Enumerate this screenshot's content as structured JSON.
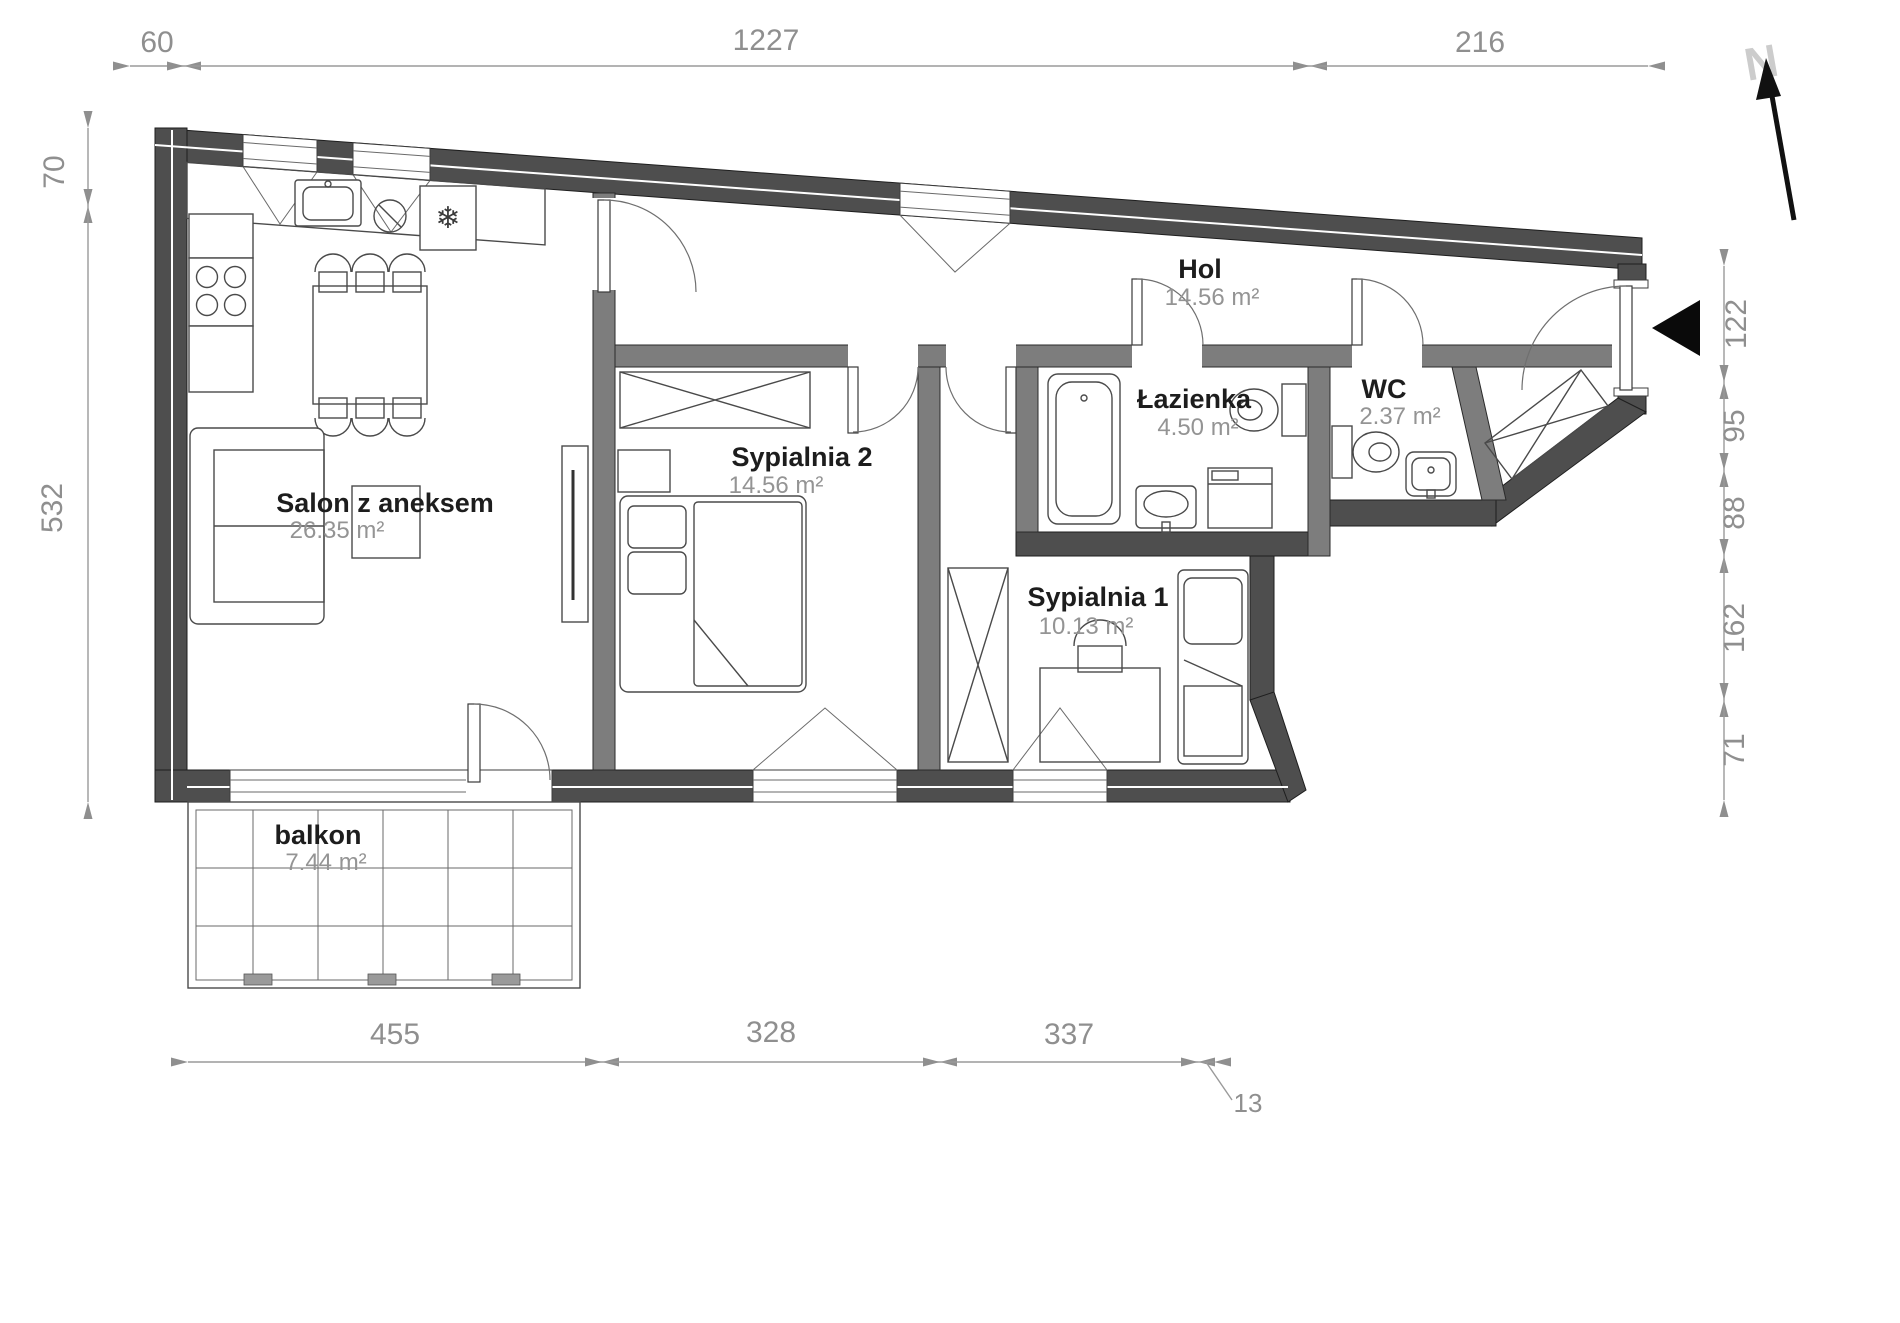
{
  "title": "Apartment floor plan",
  "rooms": {
    "salon": {
      "name": "Salon z aneksem",
      "area": "26.35 m²"
    },
    "sypialnia2": {
      "name": "Sypialnia 2",
      "area": "14.56 m²"
    },
    "sypialnia1": {
      "name": "Sypialnia 1",
      "area": "10.13 m²"
    },
    "hol": {
      "name": "Hol",
      "area": "14.56 m²"
    },
    "lazienka": {
      "name": "Łazienka",
      "area": "4.50 m²"
    },
    "wc": {
      "name": "WC",
      "area": "2.37 m²"
    },
    "balkon": {
      "name": "balkon",
      "area": "7.44 m²"
    }
  },
  "dims": {
    "top": [
      "60",
      "1227",
      "216"
    ],
    "left": [
      "70",
      "532"
    ],
    "right": [
      "122",
      "95",
      "88",
      "162",
      "71"
    ],
    "bottom": [
      "455",
      "328",
      "337",
      "13"
    ]
  },
  "compass": {
    "label": "N"
  },
  "icons": {
    "fridge_snowflake": "❄"
  },
  "colors": {
    "wall_outer": "#4e4e4e",
    "wall_inner": "#7d7d7d",
    "furniture_line": "#4a4a4a",
    "dimension": "#8f8f8f",
    "room_name": "#1d1d1d",
    "room_area": "#949494",
    "north_letter": "#cccccc",
    "entrance_marker": "#000000"
  }
}
